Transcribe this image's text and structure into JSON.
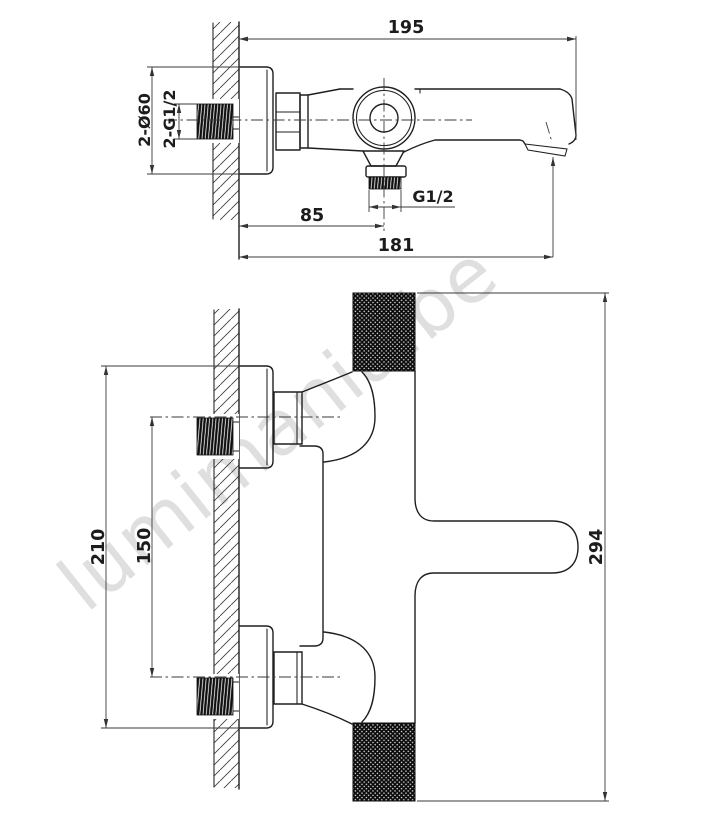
{
  "watermark": {
    "text": "lumimania.be",
    "color": "#d8d8d8"
  },
  "colors": {
    "background": "#ffffff",
    "line": "#1f1f1f",
    "dimension": "#333333"
  },
  "side_view": {
    "label": "wall-mounted bath mixer - side view",
    "dims": {
      "total_depth": "195",
      "escutcheon_diameter": "2-Ø60",
      "wall_connection_thread": "2-G1/2",
      "shower_outlet_thread": "G1/2",
      "outlet_offset": "85",
      "spout_reach": "181"
    }
  },
  "front_view": {
    "label": "wall-mounted bath mixer - front view",
    "dims": {
      "escutcheon_outer_span": "210",
      "inlet_centres": "150",
      "body_length": "294"
    }
  }
}
